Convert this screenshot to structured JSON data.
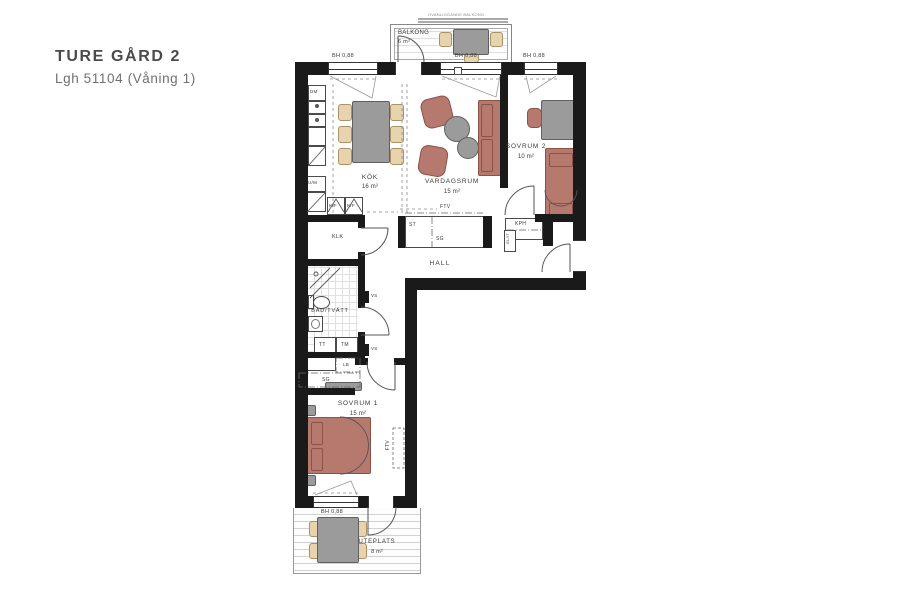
{
  "title": "TURE GÅRD 2",
  "subtitle": "Lgh 51104 (Våning 1)",
  "window_label": "BH 0,88",
  "outdoor": {
    "balkong": {
      "name": "BALKONG",
      "area": "6 m²",
      "above_note": "OVANLIGGANDE BALKONG"
    },
    "uteplats": {
      "name": "UTEPLATS",
      "area": "8 m²"
    }
  },
  "rooms": {
    "kok": {
      "name": "KÖK",
      "area": "16 m²"
    },
    "vardagsrum": {
      "name": "VARDAGSRUM",
      "area": "15 m²"
    },
    "sovrum2": {
      "name": "SOVRUM 2",
      "area": "10 m²"
    },
    "sovrum1": {
      "name": "SOVRUM 1",
      "area": "15 m²"
    },
    "hall": {
      "name": "HALL"
    },
    "bad": {
      "name": "BAD/TVÄTT"
    },
    "klk": {
      "name": "KLK"
    }
  },
  "closets": {
    "st": "ST",
    "sg": "SG",
    "kph": "KPH",
    "elit": "EL/IT",
    "lb": "LB",
    "sg2": "SG"
  },
  "appliances": {
    "dm": "DM",
    "kf": "K/F",
    "um": "U/M",
    "tt": "TT",
    "tm": "TM"
  },
  "technical": {
    "vs": "VS",
    "ftv": "FTV"
  },
  "colors": {
    "wall": "#1a1a1a",
    "furniture_red": "#b5796d",
    "furniture_red_border": "#8d5246",
    "furniture_gray": "#9b9b9b",
    "furniture_gray_border": "#606060",
    "chair_tan": "#e7d3ae",
    "chair_tan_border": "#ab9265"
  }
}
